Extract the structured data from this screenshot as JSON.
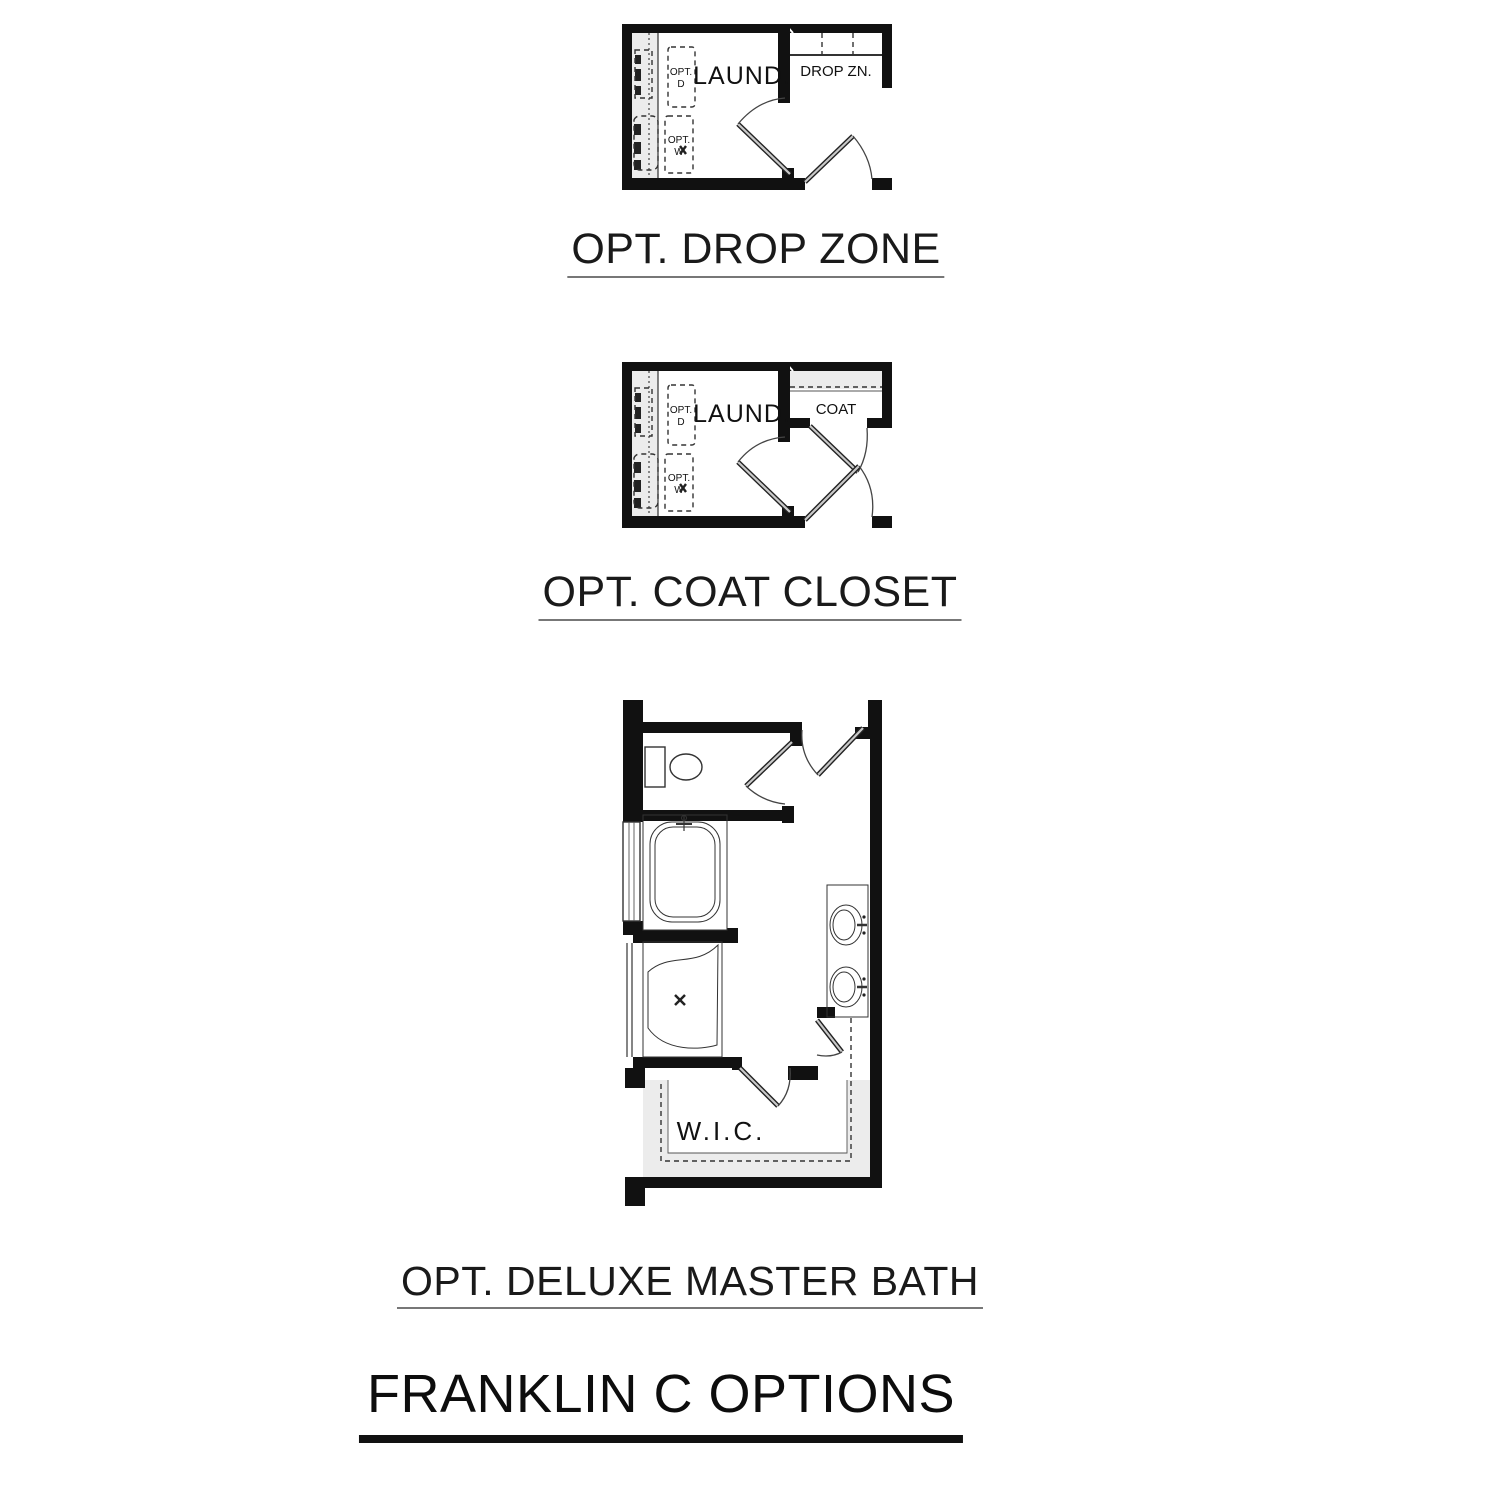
{
  "document": {
    "background": "#ffffff",
    "footer_title": "FRANKLIN C OPTIONS"
  },
  "colors": {
    "wall": "#111111",
    "line": "#333333",
    "shading": "#ececec",
    "door_leaf": "#c9c9c9",
    "title_underline": "#777777",
    "main_underline": "#111111"
  },
  "plans": [
    {
      "name": "optional drop zone",
      "title": "OPT. DROP ZONE",
      "labels": {
        "room": "LAUND.",
        "zone": "DROP ZN.",
        "opt_dryer": [
          "OPT.",
          "D"
        ],
        "opt_washer": [
          "OPT.",
          "W"
        ]
      }
    },
    {
      "name": "optional coat closet",
      "title": "OPT. COAT CLOSET",
      "labels": {
        "room": "LAUND.",
        "zone": "COAT",
        "opt_dryer": [
          "OPT.",
          "D"
        ],
        "opt_washer": [
          "OPT.",
          "W"
        ]
      }
    },
    {
      "name": "optional deluxe master bath",
      "title": "OPT. DELUXE MASTER BATH",
      "labels": {
        "closet": "W.I.C."
      }
    }
  ]
}
